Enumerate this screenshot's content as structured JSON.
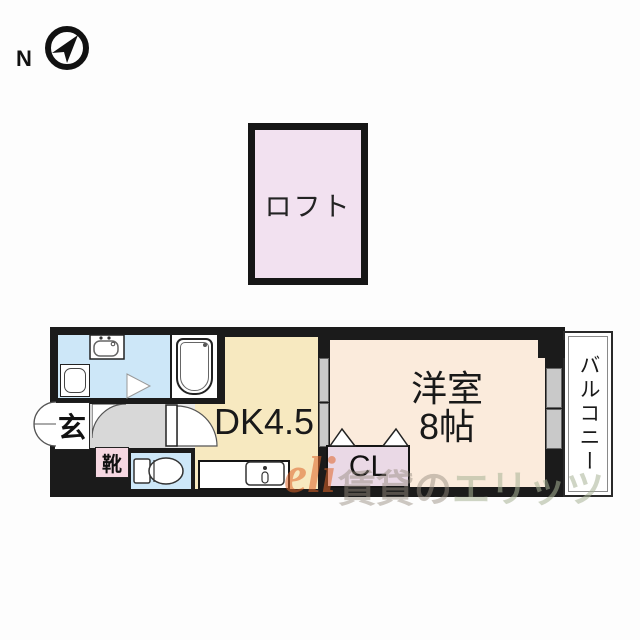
{
  "compass": {
    "label": "N"
  },
  "loft": {
    "label": "ロフト"
  },
  "plan": {
    "entrance": {
      "label": "玄"
    },
    "shoes": {
      "label": "靴"
    },
    "dk": {
      "label": "DK4.5"
    },
    "bedroom": {
      "line1": "洋室",
      "line2": "8帖"
    },
    "closet": {
      "label": "CL"
    },
    "balcony": {
      "label": "バルコニー"
    }
  },
  "watermark": {
    "logo": "eli",
    "text_gray": "賃貸の",
    "text_green": "エリッツ"
  },
  "colors": {
    "wall": "#1b1b1b",
    "water_rooms": "#cde7f8",
    "dk_floor": "#f7e9c0",
    "bedroom_floor": "#fbebdc",
    "loft_fill": "#f2e1f0",
    "closet_fill": "#ead9e6",
    "shoe_fill": "#f6d8e2",
    "hallway_fill": "#d8d8d8",
    "watermark_orange": "#de6428"
  }
}
